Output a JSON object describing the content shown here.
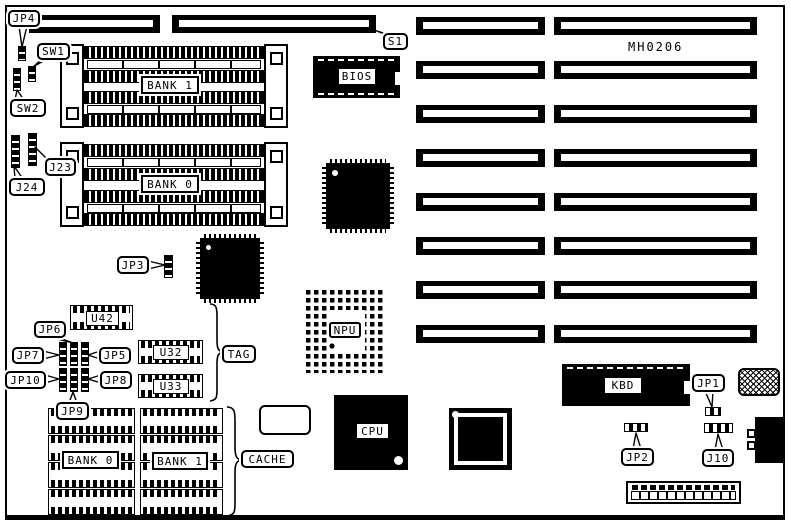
{
  "board": {
    "part_number": "MH0206",
    "expansion_slot_rows": 8,
    "top_slot_count": 1,
    "simm_sockets_per_bank": 4,
    "cache_chips_per_bank": 4
  },
  "slots": {
    "s1": "S1"
  },
  "memory": {
    "bank1": "BANK 1",
    "bank0": "BANK 0"
  },
  "cache": {
    "brace_label": "CACHE",
    "tag": "TAG",
    "bank0": "BANK 0",
    "bank1": "BANK 1"
  },
  "chips": {
    "bios": "BIOS",
    "npu": "NPU",
    "cpu": "CPU",
    "kbd": "KBD",
    "u42": "U42",
    "u32": "U32",
    "u33": "U33"
  },
  "jumpers": {
    "jp1": "JP1",
    "jp2": "JP2",
    "jp3": "JP3",
    "jp4": "JP4",
    "jp5": "JP5",
    "jp6": "JP6",
    "jp7": "JP7",
    "jp8": "JP8",
    "jp9": "JP9",
    "jp10": "JP10",
    "j10": "J10",
    "j23": "J23",
    "j24": "J24",
    "sw1": "SW1",
    "sw2": "SW2"
  }
}
